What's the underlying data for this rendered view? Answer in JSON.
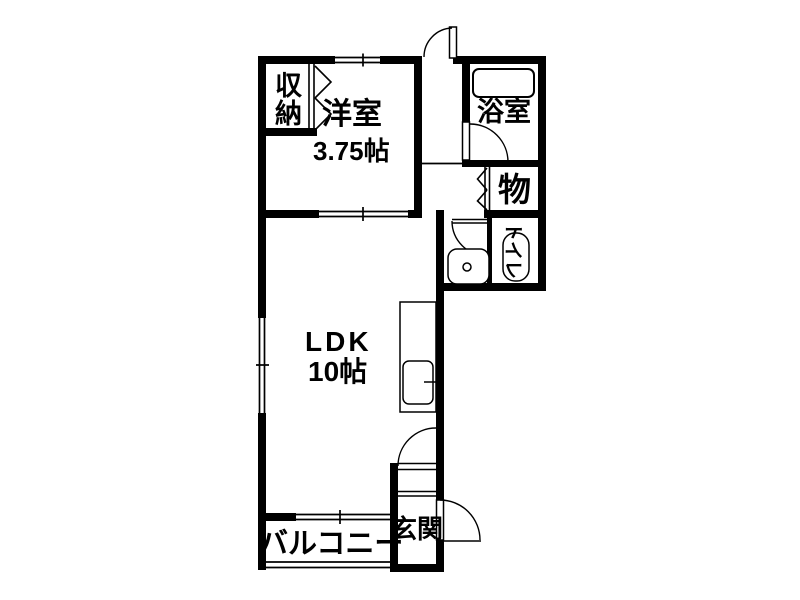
{
  "floorplan": {
    "colors": {
      "wall": "#000000",
      "background": "#ffffff",
      "line": "#000000"
    },
    "rooms": {
      "closet": {
        "label": "収納"
      },
      "western_room": {
        "label": "洋室",
        "size": "3.75帖"
      },
      "bathroom": {
        "label": "浴室"
      },
      "storage": {
        "label": "物"
      },
      "toilet": {
        "label": "トイレ"
      },
      "ldk": {
        "label": "LDK",
        "size": "10帖"
      },
      "entrance": {
        "label": "玄関"
      },
      "balcony": {
        "label": "バルコニー"
      }
    }
  }
}
